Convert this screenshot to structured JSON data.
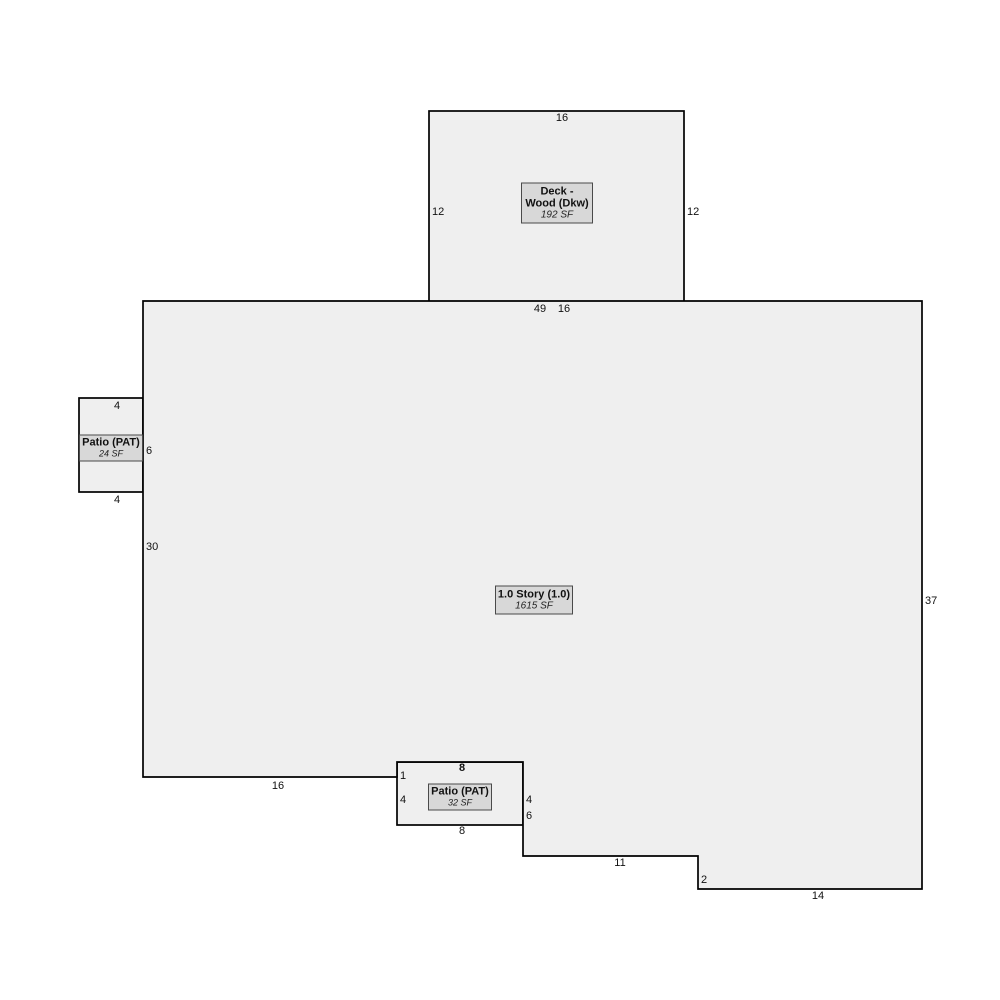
{
  "colors": {
    "shape_fill": "#efefef",
    "badge_fill": "#d8d8d8",
    "outline": "#000000",
    "background": "#ffffff"
  },
  "areas": {
    "deck": {
      "title_line1": "Deck -",
      "title_line2": "Wood (Dkw)",
      "area": "192 SF"
    },
    "story": {
      "title": "1.0 Story (1.0)",
      "area": "1615 SF"
    },
    "patio_left": {
      "title": "Patio (PAT)",
      "area": "24 SF"
    },
    "patio_bottom": {
      "title": "Patio (PAT)",
      "area": "32 SF"
    }
  },
  "dimensions": {
    "deck_top": "16",
    "deck_left": "12",
    "deck_right": "12",
    "main_top": "49",
    "deck_bottom": "16",
    "patio_left_top": "4",
    "patio_left_right": "6",
    "patio_left_bottom": "4",
    "main_left": "30",
    "main_right": "37",
    "main_bottom_left": "16",
    "patio_bottom_top": "8",
    "patio_bottom_step": "1",
    "patio_bottom_left": "4",
    "patio_bottom_right": "4",
    "notch_right": "6",
    "patio_bottom_bottom": "8",
    "main_bottom_mid": "11",
    "main_step": "2",
    "main_bottom_right": "14"
  }
}
